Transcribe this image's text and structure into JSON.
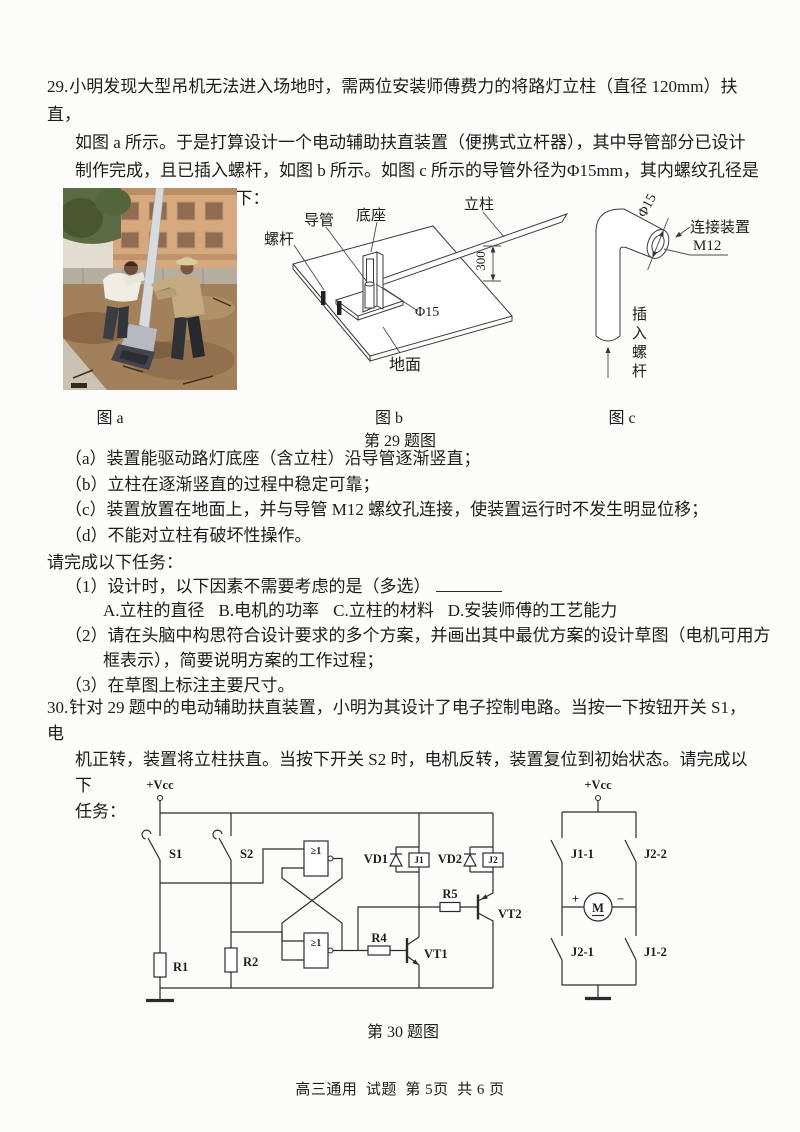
{
  "page": {
    "footer": "高三通用  试题  第 5页  共 6 页"
  },
  "q29": {
    "number": "29.",
    "lines": [
      "小明发现大型吊机无法进入场地时，需两位安装师傅费力的将路灯立柱（直径 120mm）扶直，",
      "如图 a 所示。于是打算设计一个电动辅助扶直装置（便携式立杆器），其中导管部分已设计",
      "制作完成，且已插入螺杆，如图 b 所示。如图 c 所示的导管外径为Φ15mm，其内螺纹孔径是",
      "M12mm。设计要求如下："
    ],
    "figs": {
      "a": "图 a",
      "b": "图 b",
      "c": "图 c",
      "group": "第 29 题图"
    },
    "requirements": [
      "（a）装置能驱动路灯底座（含立柱）沿导管逐渐竖直；",
      "（b）立柱在逐渐竖直的过程中稳定可靠；",
      "（c）装置放置在地面上，并与导管 M12 螺纹孔连接，使装置运行时不发生明显位移；",
      "（d）不能对立柱有破坏性操作。"
    ],
    "tasks_intro": "请完成以下任务：",
    "task1": "（1）设计时，以下因素不需要考虑的是（多选）",
    "options": [
      "A.立柱的直径",
      "B.电机的功率",
      "C.立柱的材料",
      "D.安装师傅的工艺能力"
    ],
    "task2_line1": "（2）请在头脑中构思符合设计要求的多个方案，并画出其中最优方案的设计草图（电机可用方",
    "task2_line2": "框表示），简要说明方案的工作过程；",
    "task3": "（3）在草图上标注主要尺寸。",
    "fig_b_labels": {
      "screw": "螺杆",
      "tube": "导管",
      "base": "底座",
      "pole": "立柱",
      "ground": "地面",
      "dia": "Φ15",
      "dim": "300"
    },
    "fig_c_labels": {
      "dia": "Φ15",
      "connector": "连接装置",
      "thread": "M12",
      "insert": "插入螺杆"
    }
  },
  "q30": {
    "number": "30.",
    "lines": [
      "针对 29 题中的电动辅助扶直装置，小明为其设计了电子控制电路。当按一下按钮开关 S1，电",
      "机正转，装置将立柱扶直。当按下开关 S2 时，电机反转，装置复位到初始状态。请完成以下",
      "任务："
    ],
    "fig_caption": "第 30 题图",
    "left": {
      "vcc": "+Vcc",
      "s1": "S1",
      "s2": "S2",
      "r1": "R1",
      "r2": "R2",
      "r4": "R4",
      "r5": "R5",
      "vd1": "VD1",
      "vd2": "VD2",
      "j1": "J1",
      "j2": "J2",
      "vt1": "VT1",
      "vt2": "VT2",
      "gate1": "≥1",
      "gate2": "≥1"
    },
    "right": {
      "vcc": "+Vcc",
      "j11": "J1-1",
      "j22": "J2-2",
      "j21": "J2-1",
      "j12": "J1-2",
      "motor": "M",
      "plus": "+",
      "minus": "−"
    }
  }
}
